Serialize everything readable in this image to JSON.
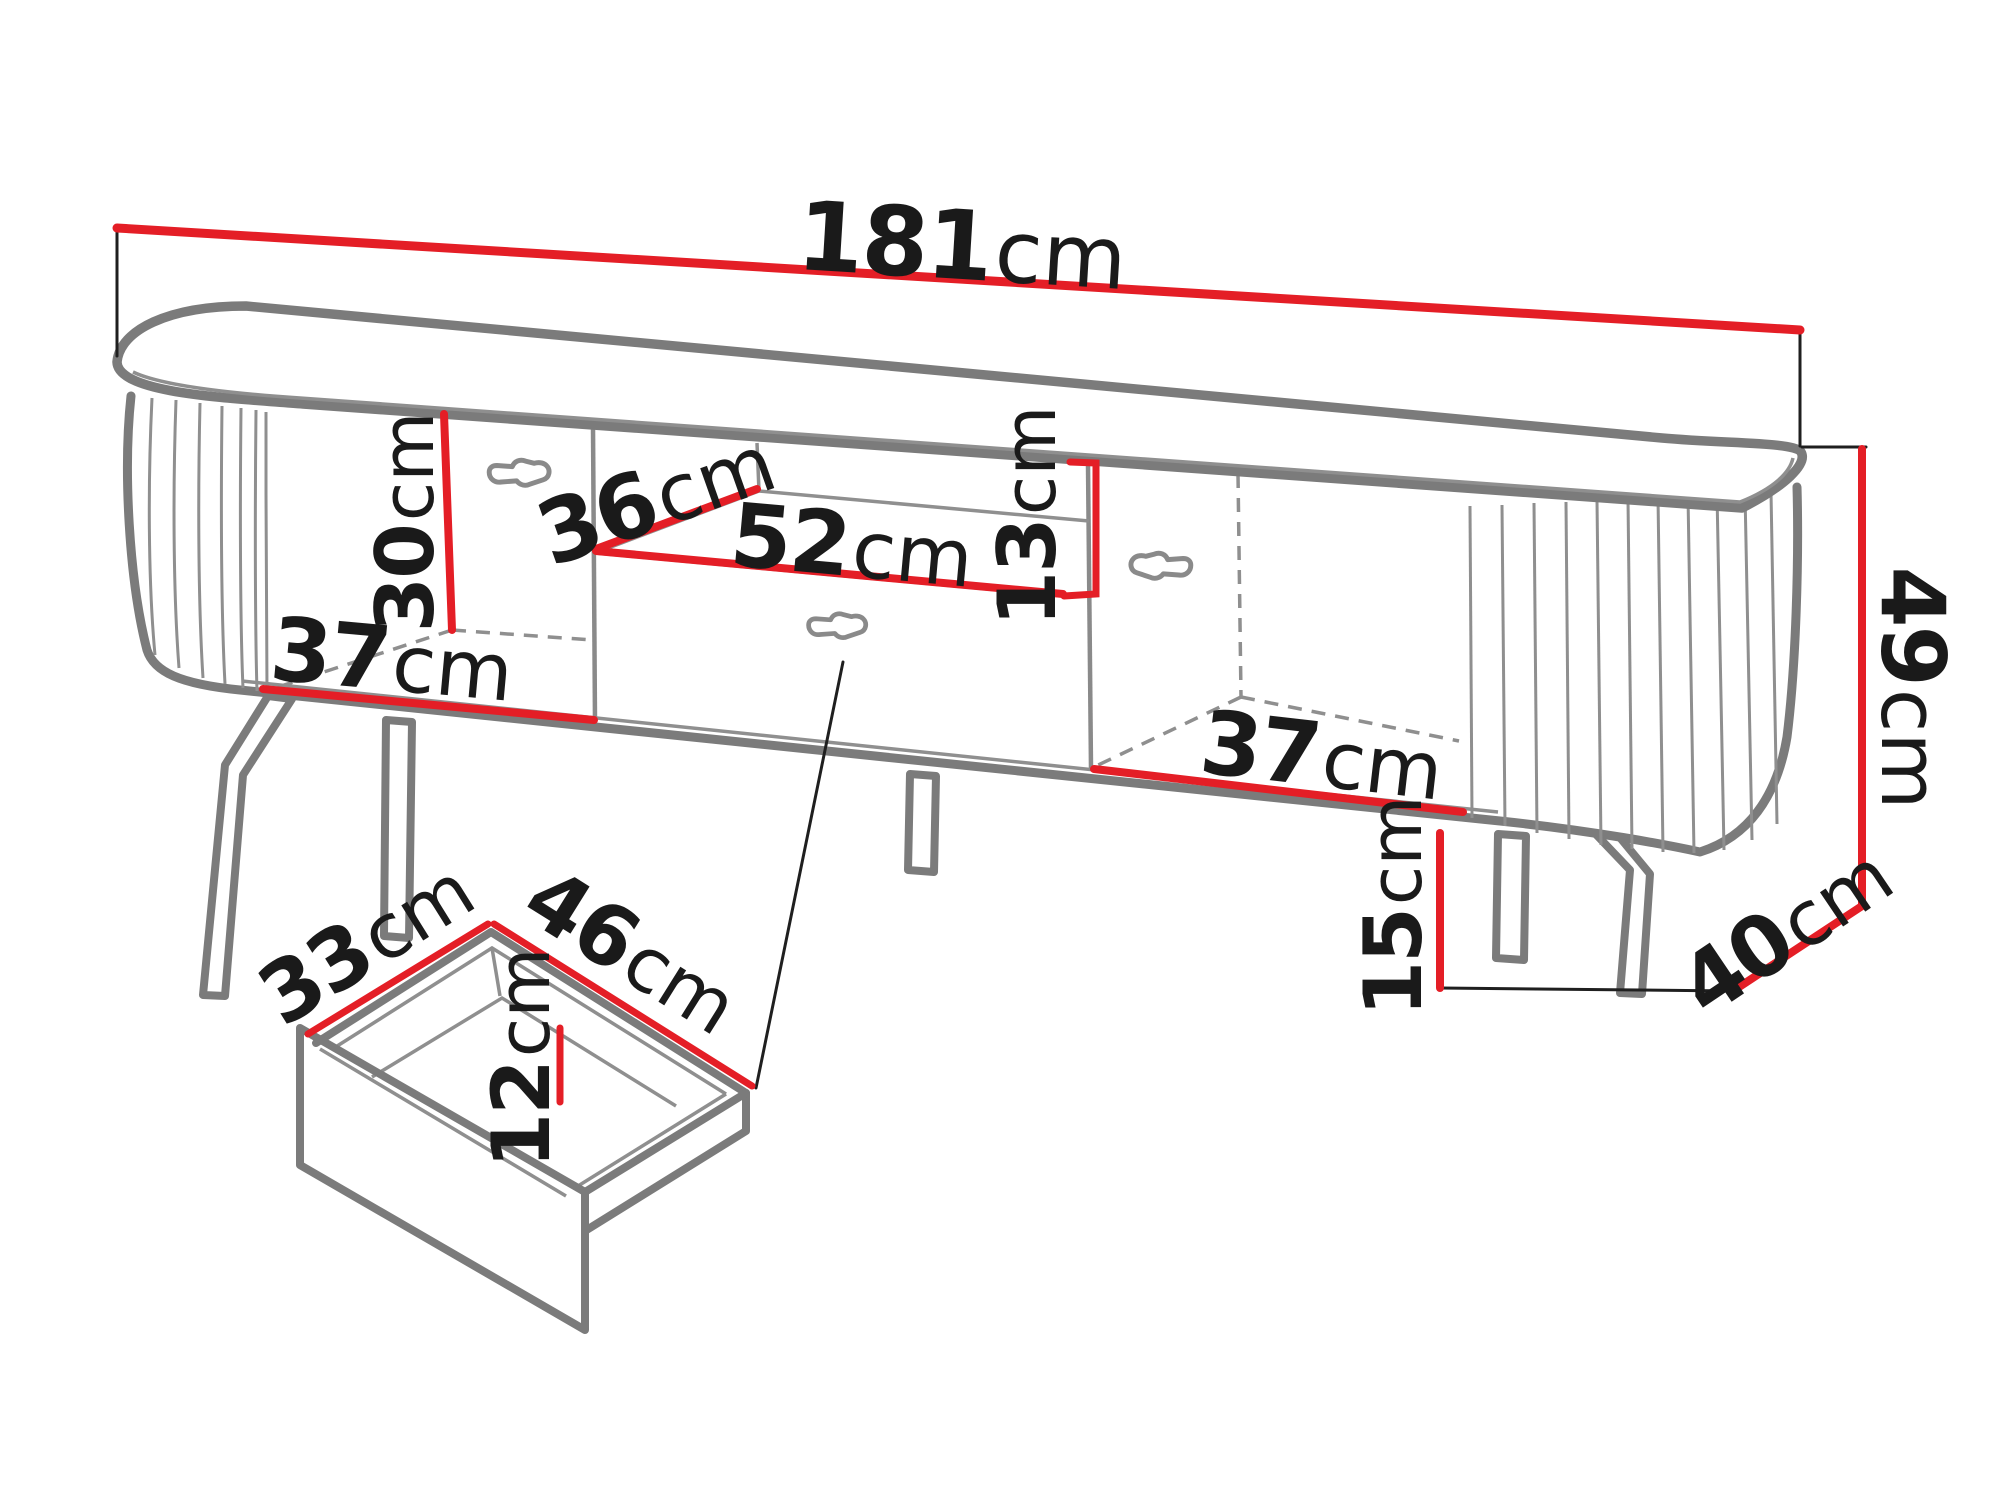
{
  "diagram": {
    "name": "tv-stand-dimension-diagram",
    "unit": "cm",
    "dims": {
      "width": {
        "value": "181",
        "unit": "cm"
      },
      "height": {
        "value": "49",
        "unit": "cm"
      },
      "depth": {
        "value": "40",
        "unit": "cm"
      },
      "side_inner_height": {
        "value": "30",
        "unit": "cm"
      },
      "left_inner_width": {
        "value": "37",
        "unit": "cm"
      },
      "shelf_depth": {
        "value": "36",
        "unit": "cm"
      },
      "niche_width": {
        "value": "52",
        "unit": "cm"
      },
      "niche_height": {
        "value": "13",
        "unit": "cm"
      },
      "right_inner_width": {
        "value": "37",
        "unit": "cm"
      },
      "legs_height": {
        "value": "15",
        "unit": "cm"
      },
      "drawer_depth": {
        "value": "33",
        "unit": "cm"
      },
      "drawer_width": {
        "value": "46",
        "unit": "cm"
      },
      "drawer_inner_height": {
        "value": "12",
        "unit": "cm"
      }
    },
    "colors": {
      "dimension_line": "#e41e26",
      "outline": "#7b7b7b",
      "thin_line": "#8f8f8f",
      "label_text": "#1a1a1a",
      "background": "#ffffff"
    }
  }
}
